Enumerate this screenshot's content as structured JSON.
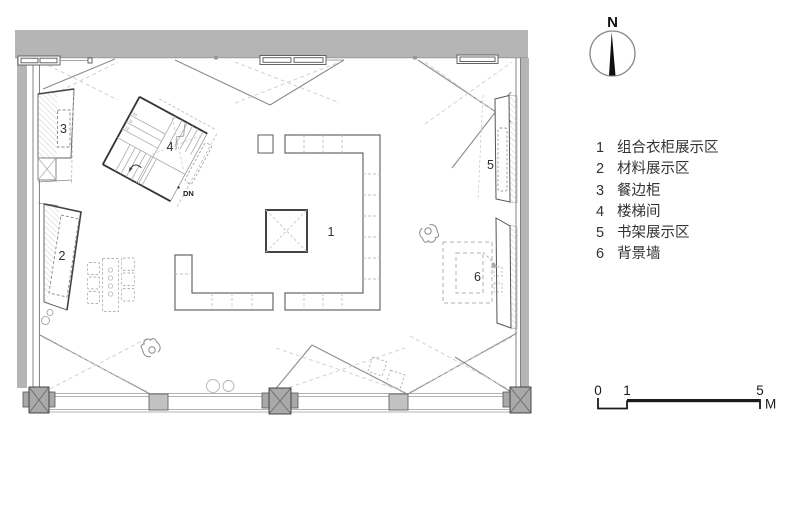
{
  "plan": {
    "area_labels": {
      "a1": "1",
      "a2": "2",
      "a3": "3",
      "a4": "4",
      "a5": "5",
      "a6": "6"
    },
    "stair": {
      "down_label": "DN",
      "step_numbers": [
        "10",
        "11",
        "12"
      ]
    }
  },
  "legend": {
    "items": [
      {
        "num": "1",
        "label": "组合衣柜展示区"
      },
      {
        "num": "2",
        "label": "材料展示区"
      },
      {
        "num": "3",
        "label": "餐边柜"
      },
      {
        "num": "4",
        "label": "楼梯间"
      },
      {
        "num": "5",
        "label": "书架展示区"
      },
      {
        "num": "6",
        "label": "背景墙"
      }
    ]
  },
  "compass": {
    "label": "N"
  },
  "scale_bar": {
    "tick_0": "0",
    "tick_1": "1",
    "tick_5": "5",
    "unit": "M"
  },
  "colors": {
    "wall_gray": "#b5b5b5",
    "column_gray": "#a9a9a9",
    "line_dark": "#3a3a3a",
    "line_mid": "#8c8c8c",
    "dash_light": "#c9c9c9",
    "scale_black": "#1b1b1b"
  }
}
